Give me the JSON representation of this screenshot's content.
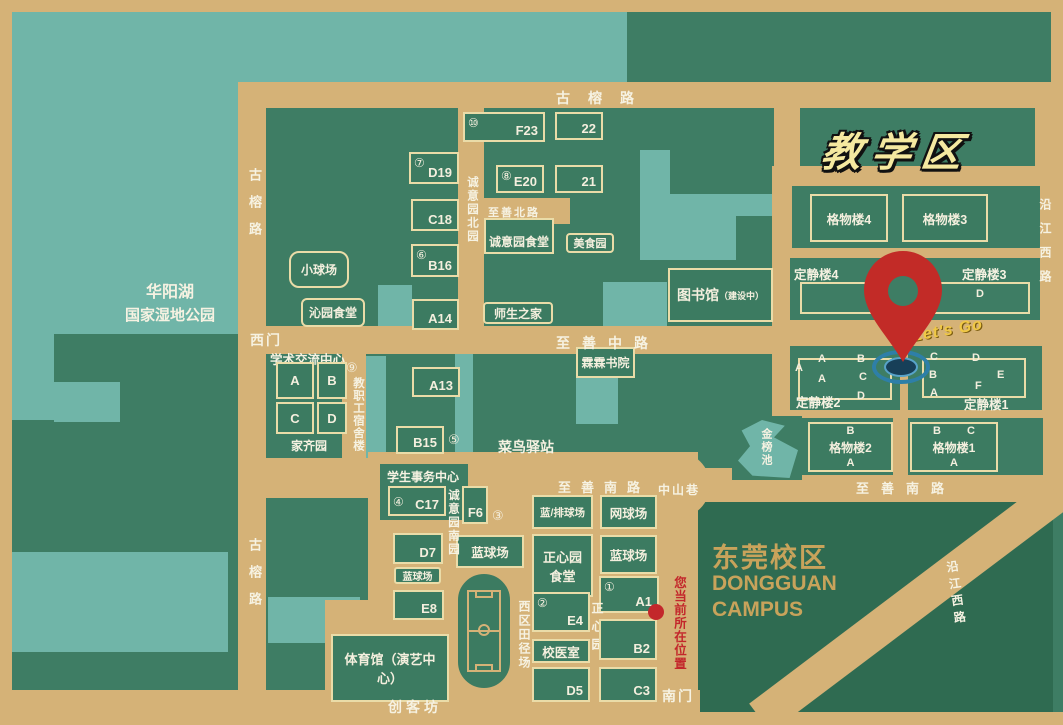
{
  "colors": {
    "background_green": "#3E7D64",
    "water_teal": "#70B5A8",
    "road_tan": "#D5B277",
    "building_outline_cream": "#EADCA8",
    "campus_block_green": "#2F6B51",
    "pin_red": "#C22B27",
    "location_red": "#C3272B",
    "title_yellow": "#F5E9A0",
    "campus_text_gold": "#C8A35B",
    "ripple_blue": "#2E7FA8"
  },
  "titles": {
    "area": "教学区",
    "lets_go": "Let's Go",
    "park_line1": "华阳湖",
    "park_line2": "国家湿地公园",
    "campus_cn": "东莞校区",
    "campus_en1": "DONGGUAN",
    "campus_en2": "CAMPUS",
    "current_location": "您当前所在位置"
  },
  "roads": {
    "gurong": "古榕路",
    "zhishan_north": "至善北路",
    "zhishan_middle": "至善中路",
    "zhishan_south": "至善南路",
    "chengyiyuan_north": "诚意园北园",
    "chengyiyuan_south": "诚意园南园",
    "zhongshan_lane": "中山巷",
    "yanjiang_west": "沿江西路",
    "chuangkefang": "创客坊",
    "west_gate": "西门",
    "south_gate": "南门",
    "faculty_dorm_num": "⑨",
    "faculty_dorm": "教职工宿舍楼",
    "zhengxinyuan": "正心园"
  },
  "pond": "金榜池",
  "buildings": {
    "f23": {
      "num": "⑩",
      "label": "F23"
    },
    "n22": {
      "label": "22"
    },
    "e20": {
      "num": "⑧",
      "label": "E20"
    },
    "n21": {
      "label": "21"
    },
    "d19": {
      "num": "⑦",
      "label": "D19"
    },
    "c18": {
      "label": "C18"
    },
    "b16": {
      "num": "⑥",
      "label": "B16"
    },
    "a14": {
      "label": "A14"
    },
    "small_ball_court": {
      "label": "小球场"
    },
    "qinyuan_canteen": {
      "label": "沁园食堂"
    },
    "chengyiyuan_canteen": {
      "label": "诚意园食堂"
    },
    "food_court": {
      "label": "美食园"
    },
    "teacher_student_home": {
      "label": "师生之家"
    },
    "library": {
      "label": "图书馆",
      "status": "（建设中）"
    },
    "linlin_academy": {
      "label": "霖霖书院"
    },
    "cainiao_station": {
      "label": "菜鸟驿站"
    },
    "gewulou4": {
      "label": "格物楼4"
    },
    "gewulou3": {
      "label": "格物楼3"
    },
    "dingjinglou4": {
      "label": "定静楼4"
    },
    "dingjinglou3": {
      "label": "定静楼3",
      "sub": "D"
    },
    "dingjinglou2": {
      "label": "定静楼2",
      "subs": [
        "A",
        "A",
        "A",
        "B",
        "C",
        "D"
      ]
    },
    "dingjinglou1": {
      "label": "定静楼1",
      "subs": [
        "C",
        "D",
        "B",
        "E",
        "A",
        "F"
      ]
    },
    "gewulou2": {
      "label": "格物楼2",
      "top": "B",
      "bottom": "A"
    },
    "gewulou1": {
      "label": "格物楼1",
      "top_left": "B",
      "top_right": "C",
      "bottom": "A"
    },
    "academic_exchange_center": {
      "label": "学术交流中心",
      "blocks": [
        "A",
        "B",
        "C",
        "D"
      ],
      "garden": "家齐园"
    },
    "a13": {
      "label": "A13"
    },
    "b15": {
      "label": "B15",
      "num": "⑤"
    },
    "student_affairs_center": {
      "label": "学生事务中心"
    },
    "c17": {
      "num": "④",
      "label": "C17"
    },
    "d7": {
      "label": "D7"
    },
    "basketball_west": {
      "label": "蓝球场"
    },
    "e8": {
      "label": "E8"
    },
    "f6": {
      "label": "F6",
      "num": "③"
    },
    "basketball_mid": {
      "label": "蓝球场"
    },
    "volleyball": {
      "label": "蓝/排球场"
    },
    "tennis": {
      "label": "网球场"
    },
    "zhengxinyuan_canteen": {
      "label": "正心园食堂"
    },
    "basketball_east": {
      "label": "蓝球场"
    },
    "a1": {
      "num": "①",
      "label": "A1"
    },
    "e4": {
      "num": "②",
      "label": "E4"
    },
    "clinic": {
      "label": "校医室"
    },
    "b2": {
      "label": "B2"
    },
    "d5": {
      "label": "D5"
    },
    "c3": {
      "label": "C3"
    },
    "gym": {
      "label": "体育馆（演艺中心）"
    },
    "west_track": {
      "label": "西区田径场"
    }
  }
}
